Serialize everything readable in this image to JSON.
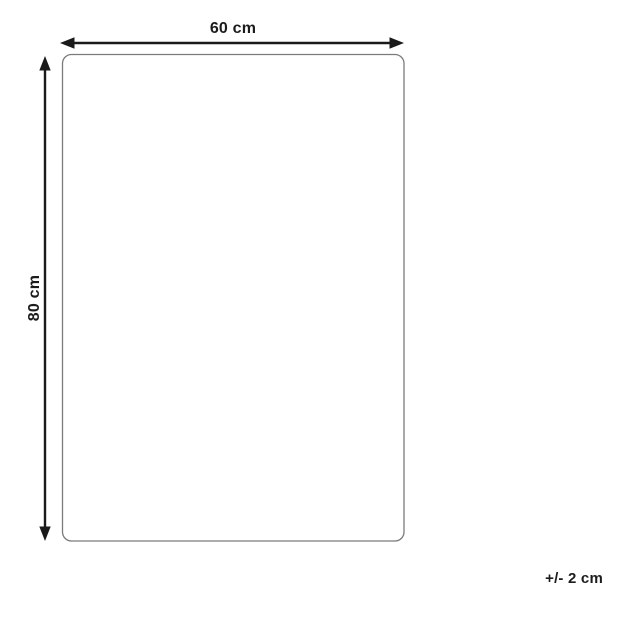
{
  "diagram": {
    "title": "product-dimension-diagram",
    "width_label": "60 cm",
    "height_label": "80 cm",
    "tolerance_label": "+/- 2 cm",
    "colors": {
      "background": "#ffffff",
      "arrow": "#1a1a1a",
      "outline": "#7b7b7b",
      "text": "#1c1c1c"
    }
  }
}
